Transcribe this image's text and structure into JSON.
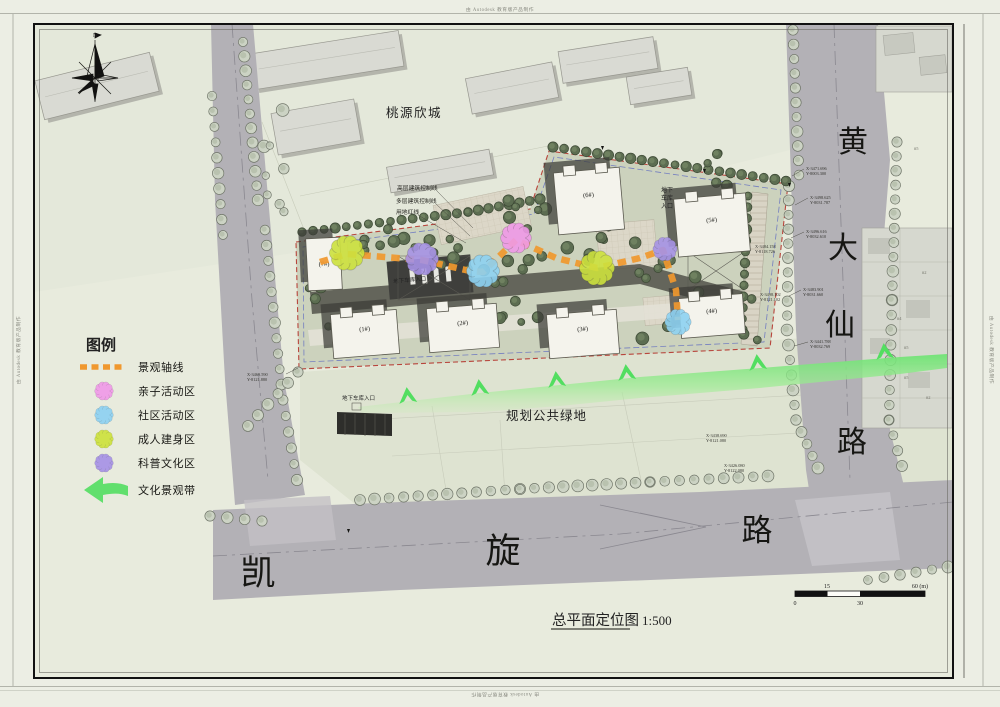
{
  "watermark": {
    "text": "由 Autodesk 教育版产品制作"
  },
  "title_block": {
    "title": "总平面定位图",
    "scale": "1:500"
  },
  "north": {
    "label": "N"
  },
  "scale_bar": {
    "tick_0": "0",
    "tick_15": "15",
    "tick_30": "30",
    "tick_60": "60 (m)"
  },
  "legend": {
    "title": "图例",
    "items": [
      {
        "label": "景观轴线",
        "color": "#f0982e",
        "type": "axis-dashed-line"
      },
      {
        "label": "亲子活动区",
        "color": "#f09ae8",
        "type": "flower"
      },
      {
        "label": "社区活动区",
        "color": "#8ed2f2",
        "type": "flower"
      },
      {
        "label": "成人建身区",
        "color": "#cde23e",
        "type": "flower"
      },
      {
        "label": "科普文化区",
        "color": "#a793e6",
        "type": "flower"
      },
      {
        "label": "文化景观带",
        "color": "#52de60",
        "type": "arrow"
      }
    ]
  },
  "map": {
    "neighborhood_label": "桃源欣城",
    "green_space_label": "规划公共绿地",
    "road_right": {
      "name": "黄大仙路",
      "chars": [
        "黄",
        "大",
        "仙",
        "路"
      ]
    },
    "road_bottom": {
      "name": "凯旋路",
      "chars": [
        "凯",
        "旋",
        "路"
      ]
    },
    "control_lines": {
      "highrise": "高层建筑控制线",
      "multistorey": "多层建筑控制线",
      "red_line": "用地红线"
    },
    "garage_entrance_label": "地下车库入口",
    "garage_entrance_lines": [
      "地下",
      "车库",
      "入口"
    ],
    "buildings": [
      {
        "label": "(1#)"
      },
      {
        "label": "(2#)"
      },
      {
        "label": "(3#)"
      },
      {
        "label": "(4#)"
      },
      {
        "label": "(5#)"
      },
      {
        "label": "(6#)"
      },
      {
        "label": "(7#)"
      }
    ],
    "parcel_labels": [
      "#5",
      "#2",
      "#4",
      "#5",
      "#5",
      "#2"
    ],
    "coords": [
      {
        "x": "X-3471.696",
        "y": "Y-8003.300"
      },
      {
        "x": "X-3498.625",
        "y": "Y-8031.787"
      },
      {
        "x": "X-3496.616",
        "y": "Y-8032.610"
      },
      {
        "x": "X-3484.158",
        "y": "Y-8118.726"
      },
      {
        "x": "X-3483.901",
        "y": "Y-8031.660"
      },
      {
        "x": "X-3498.102",
        "y": "Y-8121.102"
      },
      {
        "x": "X-3441.788",
        "y": "Y-8032.769"
      },
      {
        "x": "X-3469.590",
        "y": "Y-8121.880"
      },
      {
        "x": "X-3438.690",
        "y": "Y-8121.080"
      },
      {
        "x": "X-3426.080",
        "y": "Y-8122.080"
      }
    ]
  },
  "colors": {
    "paper": "#eceee4",
    "road": "#b3b1b6",
    "site_green": "#ccd2bd",
    "green_belt": "#7fe882",
    "red_line": "#b8453c",
    "blue_line": "#5763c2",
    "tree_dark": "#5d6e52",
    "tree_light": "#cbd2c3"
  }
}
